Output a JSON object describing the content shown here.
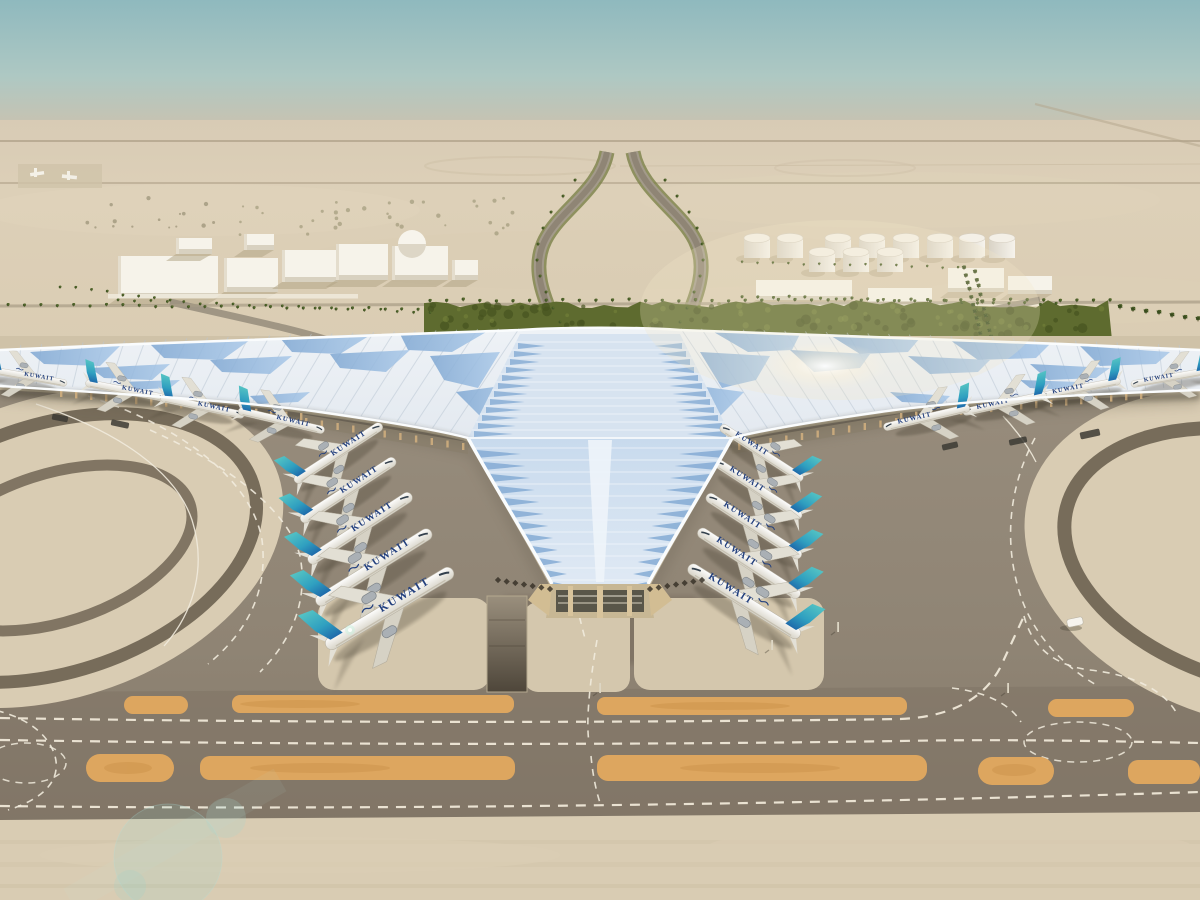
{
  "meta": {
    "description": "Aerial daytime architectural rendering of Kuwait International Airport Terminal 2: a vast swooping silver roof with blue glazed ribs shaped like a trefoil wing, rows of Kuwait Airways aircraft parked nose-in at both arms, sand-colored aprons, dark taxiways with white dashed centerlines and orange shoulder strips, a palm-lined approach highway, white warehouse buildings and a fuel tank farm in the desert background under a hazy teal sky."
  },
  "palette": {
    "sky_top": "#8fb9be",
    "sky_mid": "#b7cfc8",
    "haze": "#d6cab4",
    "sand": "#ddd0b8",
    "sand_deep": "#d2c4aa",
    "sand_light": "#d9ccb3",
    "concrete": "#cfc2a8",
    "pad": "#d4c7ad",
    "asphalt": "#968b7b",
    "asphalt_dark": "#7d7163",
    "arc": "#776c5a",
    "orange": "#dda65f",
    "orange_dark": "#c98f45",
    "roof_light": "#eef2f6",
    "roof_shade": "#cdd7e2",
    "rib": "#b9c6d4",
    "glass": "#9dc0e2",
    "glass_deep": "#7fa7d2",
    "facade_light": "#dfe9f4",
    "edge_white": "#fafcfd",
    "under_shadow": "#332d24",
    "tan": "#cfae7e",
    "hedge": "#5e6b2f",
    "palm_green": "#415624",
    "trunk": "#6e5e41",
    "navy": "#23407e",
    "teal": "#52c4c2",
    "tail_blue": "#1c5fa5",
    "fus_white": "#f7f5ef",
    "wing": "#e2dfd4",
    "shadow": "#463f31",
    "white_bld": "#f6f3ea",
    "bld_shade": "#d8d1c0",
    "tank_light": "#f4f0e7",
    "mk_white": "#f1ebdd",
    "mk_white2": "#efe8d8"
  },
  "aircraft": {
    "livery_title": "KUWAIT",
    "count": 18,
    "fleet_positions": [
      [
        30,
        377,
        10,
        0.75,
        0
      ],
      [
        128,
        391,
        11,
        0.8,
        0
      ],
      [
        204,
        407,
        12,
        0.82,
        0
      ],
      [
        283,
        421,
        13,
        0.85,
        0
      ],
      [
        340,
        452,
        -33,
        1.0,
        0
      ],
      [
        350,
        489,
        -33,
        1.08,
        0
      ],
      [
        362,
        527,
        -33,
        1.18,
        0
      ],
      [
        376,
        566,
        -32,
        1.3,
        0
      ],
      [
        392,
        607,
        -31,
        1.42,
        0
      ],
      [
        760,
        452,
        33,
        0.94,
        1
      ],
      [
        756,
        488,
        33,
        1.0,
        1
      ],
      [
        752,
        525,
        33,
        1.08,
        1
      ],
      [
        747,
        562,
        33,
        1.16,
        1
      ],
      [
        742,
        600,
        32,
        1.26,
        1
      ],
      [
        1078,
        389,
        -11,
        0.8,
        1
      ],
      [
        1003,
        404,
        -12,
        0.82,
        1
      ],
      [
        925,
        418,
        -13,
        0.85,
        1
      ],
      [
        1168,
        378,
        -10,
        0.75,
        1
      ]
    ]
  },
  "terminal": {
    "rib_count": 26
  },
  "palms": {
    "rows": [
      {
        "x1": 8,
        "y1": 304,
        "x2": 418,
        "y2": 309,
        "n": 26,
        "s": 0.55
      },
      {
        "x1": 430,
        "y1": 300,
        "x2": 1110,
        "y2": 300,
        "n": 42,
        "s": 0.6
      },
      {
        "x1": 1120,
        "y1": 306,
        "x2": 1198,
        "y2": 318,
        "n": 7,
        "s": 0.8
      },
      {
        "x1": 118,
        "y1": 300,
        "x2": 430,
        "y2": 312,
        "n": 20,
        "s": 0.5
      },
      {
        "x1": 60,
        "y1": 286,
        "x2": 170,
        "y2": 300,
        "n": 8,
        "s": 0.5
      },
      {
        "x1": 742,
        "y1": 296,
        "x2": 1056,
        "y2": 304,
        "n": 21,
        "s": 0.55
      },
      {
        "x1": 742,
        "y1": 262,
        "x2": 958,
        "y2": 267,
        "n": 15,
        "s": 0.45
      },
      {
        "x1": 964,
        "y1": 268,
        "x2": 982,
        "y2": 340,
        "n": 11,
        "s": 0.7
      },
      {
        "x1": 975,
        "y1": 272,
        "x2": 993,
        "y2": 344,
        "n": 11,
        "s": 0.7
      }
    ],
    "curves": [
      {
        "s": 0.55,
        "pts": [
          [
            575,
            180
          ],
          [
            563,
            196
          ],
          [
            551,
            212
          ],
          [
            543,
            228
          ],
          [
            538,
            244
          ],
          [
            537,
            260
          ],
          [
            540,
            276
          ],
          [
            546,
            292
          ],
          [
            553,
            308
          ],
          [
            560,
            322
          ]
        ]
      },
      {
        "s": 0.55,
        "pts": [
          [
            665,
            180
          ],
          [
            677,
            196
          ],
          [
            689,
            212
          ],
          [
            697,
            228
          ],
          [
            702,
            244
          ],
          [
            703,
            260
          ],
          [
            700,
            276
          ],
          [
            694,
            292
          ],
          [
            687,
            308
          ],
          [
            680,
            322
          ]
        ]
      }
    ]
  },
  "buildings": {
    "left": [
      [
        118,
        256,
        100,
        42
      ],
      [
        224,
        258,
        54,
        34
      ],
      [
        282,
        250,
        56,
        32
      ],
      [
        176,
        238,
        36,
        16
      ],
      [
        244,
        234,
        30,
        16
      ],
      [
        336,
        244,
        52,
        36
      ],
      [
        452,
        260,
        26,
        20
      ]
    ],
    "dome_building": [
      392,
      246,
      56,
      34
    ],
    "dome": [
      412,
      244,
      14
    ],
    "right": [
      [
        756,
        280,
        96,
        20
      ],
      [
        868,
        288,
        64,
        18
      ],
      [
        948,
        268,
        56,
        24
      ],
      [
        1008,
        276,
        44,
        18
      ]
    ]
  },
  "tanks": {
    "rows": [
      {
        "y": 238,
        "xs": [
          757,
          790,
          838,
          872,
          906,
          940,
          972,
          1002
        ]
      },
      {
        "y": 252,
        "xs": [
          822,
          856,
          890
        ]
      }
    ]
  },
  "vehicles": {
    "white_van": [
      1075,
      622,
      16,
      8,
      -12
    ],
    "dark_units": [
      [
        1090,
        434,
        20,
        7,
        -12
      ],
      [
        1018,
        441,
        18,
        6,
        -12
      ],
      [
        120,
        424,
        18,
        6,
        12
      ],
      [
        60,
        418,
        16,
        6,
        11
      ],
      [
        950,
        446,
        16,
        6,
        -13
      ]
    ],
    "posts": [
      [
        772,
        645
      ],
      [
        838,
        627
      ],
      [
        1008,
        688
      ],
      [
        600,
        688
      ]
    ]
  }
}
